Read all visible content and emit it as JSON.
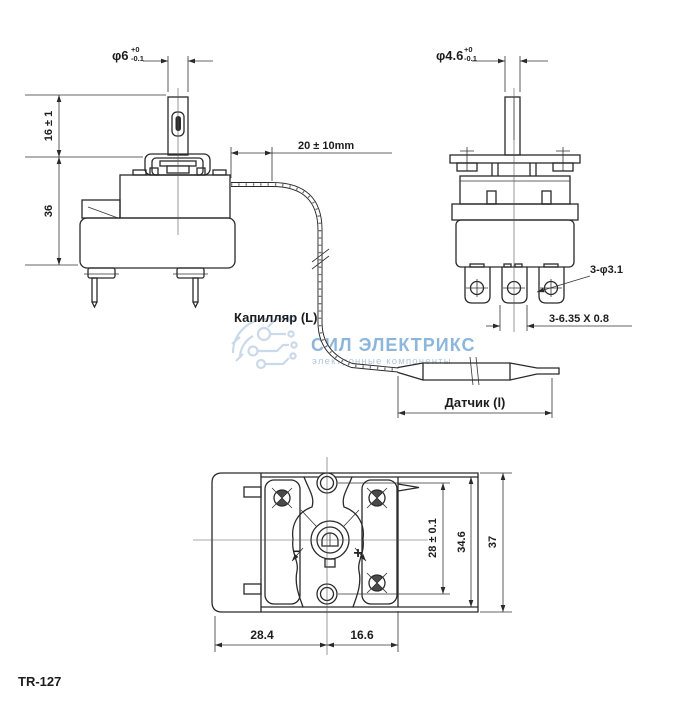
{
  "model_label": "TR-127",
  "watermark": {
    "title": "СИЛ ЭЛЕКТРИКС",
    "subtitle": "электронные компоненты",
    "title_color": "#74a7d4",
    "logo_color": "#c6d7e8"
  },
  "colors": {
    "line": "#2a2a2a",
    "background": "#ffffff"
  },
  "front_view": {
    "shaft_diameter": {
      "dia": "φ6",
      "tol_plus": "+0",
      "tol_minus": "-0.1"
    },
    "shaft_height": "16 ± 1",
    "body_height": "36",
    "capillary_bend_length": "20 ± 10mm"
  },
  "side_view": {
    "shaft_diameter": {
      "dia": "φ4.6",
      "tol_plus": "+0",
      "tol_minus": "-0.1"
    },
    "terminal_hole": "3-φ3.1",
    "terminal_size": "3-6.35 X 0.8"
  },
  "capillary": {
    "label": "Капилляр (L)"
  },
  "sensor": {
    "label": "Датчик (l)"
  },
  "bottom_view": {
    "hole_spacing": "28 ± 0.1",
    "bracket_height": "34.6",
    "overall_height": "37",
    "body_width": "28.4",
    "bracket_width": "16.6",
    "adjust_decrease": "−",
    "adjust_increase": "+"
  }
}
